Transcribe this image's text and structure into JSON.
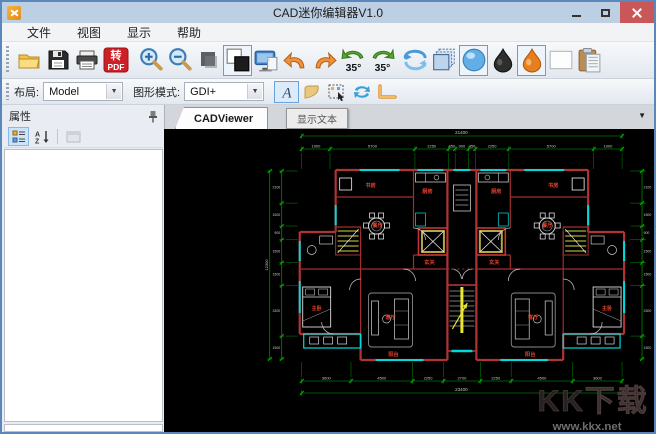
{
  "window": {
    "title": "CAD迷你编辑器V1.0",
    "control_icons": [
      "minimize-icon",
      "maximize-icon",
      "close-icon"
    ]
  },
  "menu": {
    "items": [
      "文件",
      "视图",
      "显示",
      "帮助"
    ]
  },
  "toolbar_main": {
    "icons": [
      "open-folder",
      "save",
      "print",
      "convert-pdf",
      "zoom-in",
      "zoom-out",
      "fit-square",
      "background-toggle",
      "screen-page",
      "undo",
      "redo",
      "rotate-left-35",
      "rotate-right-35",
      "rotate-view",
      "layers",
      "render-sphere",
      "ink-black",
      "ink-orange",
      "blank-page",
      "paste-clipboard"
    ],
    "pdf_text_top": "转",
    "pdf_text_bottom": "PDF",
    "rotate_left_label": "35°",
    "rotate_right_label": "35°"
  },
  "toolbar_view": {
    "layout_label": "布局:",
    "layout_value": "Model",
    "mode_label": "图形模式:",
    "mode_value": "GDI+",
    "icons": [
      "show-text",
      "show-lineweight",
      "select-marquee",
      "swap-colors",
      "polyline"
    ]
  },
  "tooltip": {
    "text": "显示文本"
  },
  "panel": {
    "title": "属性",
    "toolbar_icons": [
      "categorized",
      "sort-alphabetical",
      "property-pages"
    ]
  },
  "viewer": {
    "tab_label": "CADViewer",
    "tab_dropdown_icon": "chevron-down-icon"
  },
  "drawing": {
    "background": "#000000",
    "colors": {
      "wall": "#b13434",
      "window_line": "#00dada",
      "dimension": "#00b400",
      "dim_text": "#c8c8c8",
      "label": "#e8402a",
      "furniture": "#d8d8d8",
      "stair": "#e8e832"
    },
    "dimensions": {
      "top": {
        "total": "21400",
        "segments": [
          "1900",
          "5700",
          "2250",
          "450",
          "900",
          "450",
          "2250",
          "5700",
          "1900"
        ]
      },
      "bottom": {
        "total": "23400",
        "segments": [
          "3600",
          "4500",
          "2250",
          "2700",
          "2250",
          "4500",
          "3600"
        ]
      },
      "left": {
        "total": "12300",
        "segments": [
          "2100",
          "1500",
          "900",
          "1500",
          "1500",
          "3300",
          "1500"
        ]
      },
      "right": {
        "total": "12300",
        "segments": [
          "2100",
          "1500",
          "900",
          "1500",
          "1500",
          "3300",
          "1500"
        ]
      }
    },
    "room_labels": [
      {
        "t": "书房",
        "x": 207,
        "y": 58
      },
      {
        "t": "书房",
        "x": 390,
        "y": 58
      },
      {
        "t": "厨房",
        "x": 264,
        "y": 64
      },
      {
        "t": "厨房",
        "x": 333,
        "y": 64
      },
      {
        "t": "餐厅",
        "x": 214,
        "y": 98
      },
      {
        "t": "餐厅",
        "x": 384,
        "y": 98
      },
      {
        "t": "玄关",
        "x": 266,
        "y": 135
      },
      {
        "t": "玄关",
        "x": 331,
        "y": 135
      },
      {
        "t": "客厅",
        "x": 227,
        "y": 190
      },
      {
        "t": "客厅",
        "x": 370,
        "y": 190
      },
      {
        "t": "主卧",
        "x": 153,
        "y": 181
      },
      {
        "t": "主卧",
        "x": 444,
        "y": 181
      },
      {
        "t": "阳台",
        "x": 230,
        "y": 227
      },
      {
        "t": "阳台",
        "x": 367,
        "y": 227
      }
    ],
    "watermark": {
      "line1": "KK下载",
      "line2": "www.kkx.net"
    }
  }
}
